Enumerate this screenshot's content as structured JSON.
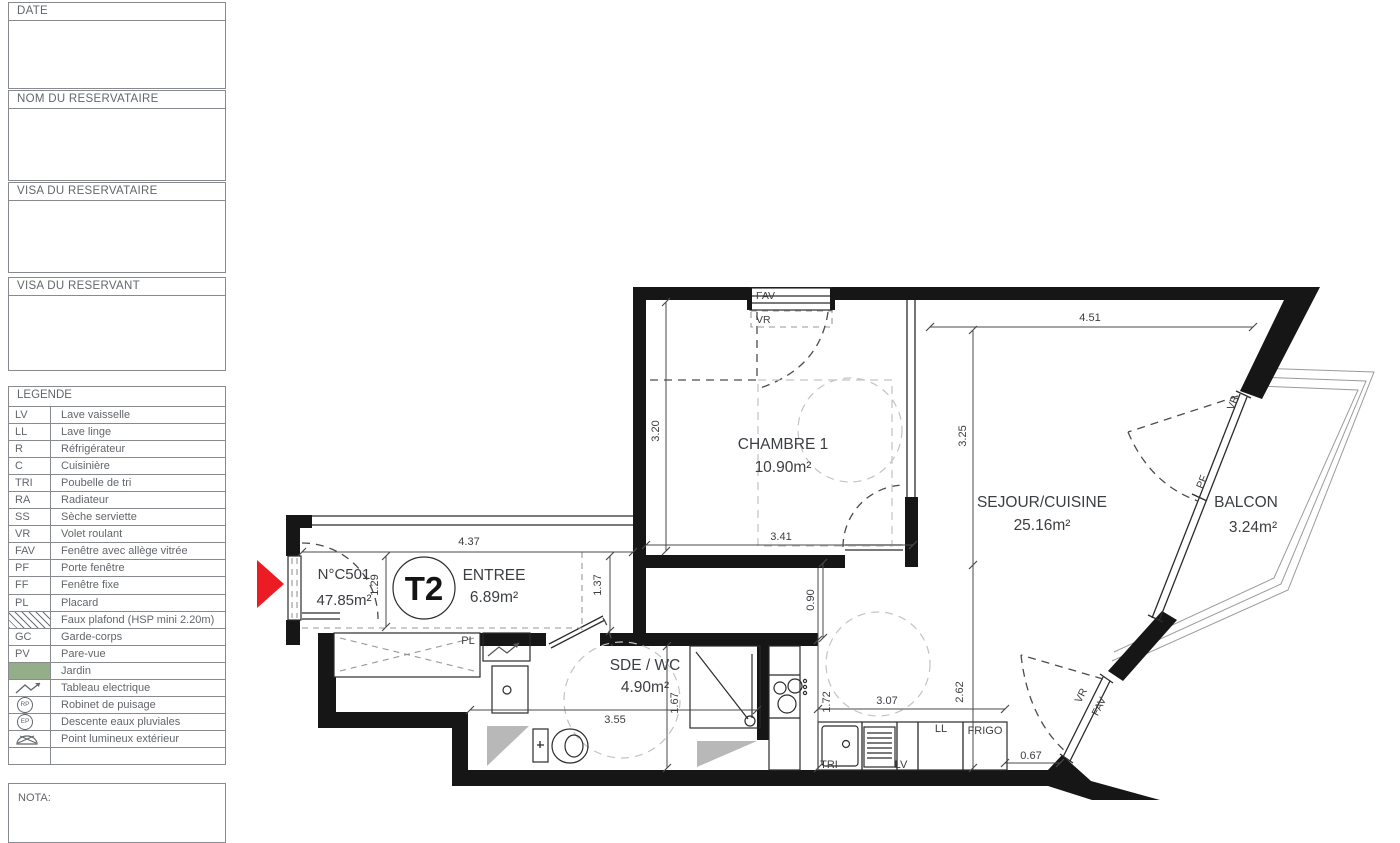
{
  "sidebar": {
    "boxes": [
      "DATE",
      "NOM DU RESERVATAIRE",
      "VISA DU RESERVATAIRE",
      "VISA DU RESERVANT"
    ],
    "legend_title": "LEGENDE",
    "legend": [
      {
        "abbr": "LV",
        "label": "Lave vaisselle"
      },
      {
        "abbr": "LL",
        "label": "Lave linge"
      },
      {
        "abbr": "R",
        "label": "Réfrigérateur"
      },
      {
        "abbr": "C",
        "label": "Cuisinière"
      },
      {
        "abbr": "TRI",
        "label": "Poubelle de tri"
      },
      {
        "abbr": "RA",
        "label": "Radiateur"
      },
      {
        "abbr": "SS",
        "label": "Sèche serviette"
      },
      {
        "abbr": "VR",
        "label": "Volet roulant"
      },
      {
        "abbr": "FAV",
        "label": "Fenêtre avec allège vitrée"
      },
      {
        "abbr": "PF",
        "label": "Porte fenêtre"
      },
      {
        "abbr": "FF",
        "label": "Fenêtre fixe"
      },
      {
        "abbr": "PL",
        "label": "Placard"
      },
      {
        "abbr": "",
        "icon": "hatch-icon",
        "label": "Faux plafond (HSP mini 2.20m)"
      },
      {
        "abbr": "GC",
        "label": "Garde-corps"
      },
      {
        "abbr": "PV",
        "label": "Pare-vue"
      },
      {
        "abbr": "",
        "icon": "jardin-swatch",
        "label": "Jardin"
      },
      {
        "abbr": "",
        "icon": "zigzag-icon",
        "label": "Tableau electrique"
      },
      {
        "abbr": "RP",
        "icon": "circle-icon",
        "label": "Robinet de puisage"
      },
      {
        "abbr": "EP",
        "icon": "circle-icon",
        "label": "Descente eaux pluviales"
      },
      {
        "abbr": "",
        "icon": "lamp-icon",
        "label": "Point lumineux extérieur"
      },
      {
        "abbr": "",
        "label": ""
      }
    ],
    "nota_label": "NOTA:"
  },
  "plan": {
    "unit_number": "N°C501",
    "unit_area": "47.85m²",
    "unit_type": "T2",
    "rooms": [
      {
        "name": "CHAMBRE 1",
        "area": "10.90m²"
      },
      {
        "name": "SEJOUR/CUISINE",
        "area": "25.16m²"
      },
      {
        "name": "BALCON",
        "area": "3.24m²"
      },
      {
        "name": "ENTREE",
        "area": "6.89m²"
      },
      {
        "name": "SDE / WC",
        "area": "4.90m²"
      }
    ],
    "labels": {
      "pl": "PL",
      "tri": "TRI",
      "lv": "LV",
      "ll": "LL",
      "frigo": "FRIGO"
    },
    "windows": {
      "fav": "FAV",
      "vr": "VR",
      "pf": "PF"
    },
    "dims": {
      "d451": "4.51",
      "d320": "3.20",
      "d325": "3.25",
      "d341": "3.41",
      "d437": "4.37",
      "d129": "1.29",
      "d137": "1.37",
      "d090": "0.90",
      "d355": "3.55",
      "d167": "1.67",
      "d172": "1.72",
      "d307": "3.07",
      "d262": "2.62",
      "d067": "0.67"
    }
  },
  "colors": {
    "marker_red": "#ec1c24",
    "jardin_green": "#93ae89",
    "wall_black": "#161616"
  }
}
